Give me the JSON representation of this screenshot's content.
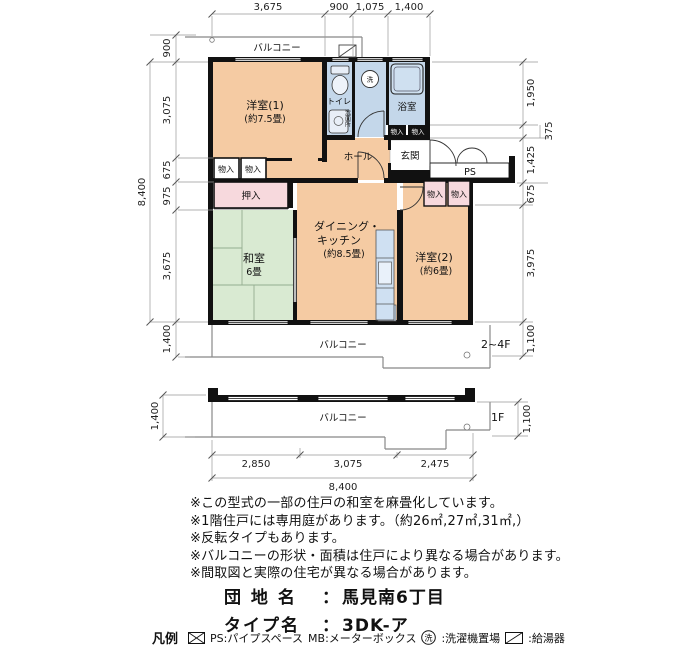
{
  "plan": {
    "balcony_top_label": "バルコニー",
    "balcony_mid_label": "バルコニー",
    "balcony_1f_label": "バルコニー",
    "floor_mid": "2~4F",
    "floor_1f": "1F",
    "rooms": {
      "western1": "洋室(1)",
      "western1_size": "(約7.5畳)",
      "toilet": "トイレ",
      "washroom": "洗面所",
      "bath": "浴室",
      "hall": "ホール",
      "entrance": "玄関",
      "ps": "PS",
      "closet": "物入",
      "oshiire": "押入",
      "japanese": "和室",
      "japanese_size": "6畳",
      "dk_line1": "ダイニング・",
      "dk_line2": "キッチン",
      "dk_size": "(約8.5畳)",
      "western2": "洋室(2)",
      "western2_size": "(約6畳)",
      "laundry_mark": "洗"
    }
  },
  "dimensions": {
    "top": [
      "3,675",
      "900",
      "1,075",
      "1,400"
    ],
    "left": [
      "900",
      "3,075",
      "675",
      "975",
      "3,675",
      "1,400"
    ],
    "left_total": "8,400",
    "right": [
      "1,950",
      "375",
      "1,425",
      "675",
      "3,975",
      "1,100"
    ],
    "f1_left": "1,400",
    "f1_right": "1,100",
    "bottom": [
      "2,850",
      "3,075",
      "2,475"
    ],
    "bottom_total": "8,400"
  },
  "notes": [
    "※この型式の一部の住戸の和室を麻畳化しています。",
    "※1階住戸には専用庭があります。（約26㎡,27㎡,31㎡,）",
    "※反転タイプもあります。",
    "※バルコニーの形状・面積は住戸により異なる場合があります。",
    "※間取図と実際の住宅が異なる場合があります。"
  ],
  "property": {
    "estate_label": "団 地 名",
    "estate_sep": "：",
    "estate_value": "馬見南6丁目",
    "type_label": "タイプ名",
    "type_sep": "：",
    "type_value": "3DK-ア"
  },
  "legend": {
    "title": "凡例",
    "ps_text": "PS:パイプスペース",
    "mb_text": "MB:メーターボックス",
    "laundry_symbol": "洗",
    "laundry_text": ":洗濯機置場",
    "heater_text": ":給湯器"
  },
  "colors": {
    "room_peach": "#f5cba3",
    "tatami_green": "#d9ead2",
    "sanitary_blue": "#c4d7ea",
    "closet_pink": "#f7d9dd",
    "wall_black": "#111111"
  }
}
